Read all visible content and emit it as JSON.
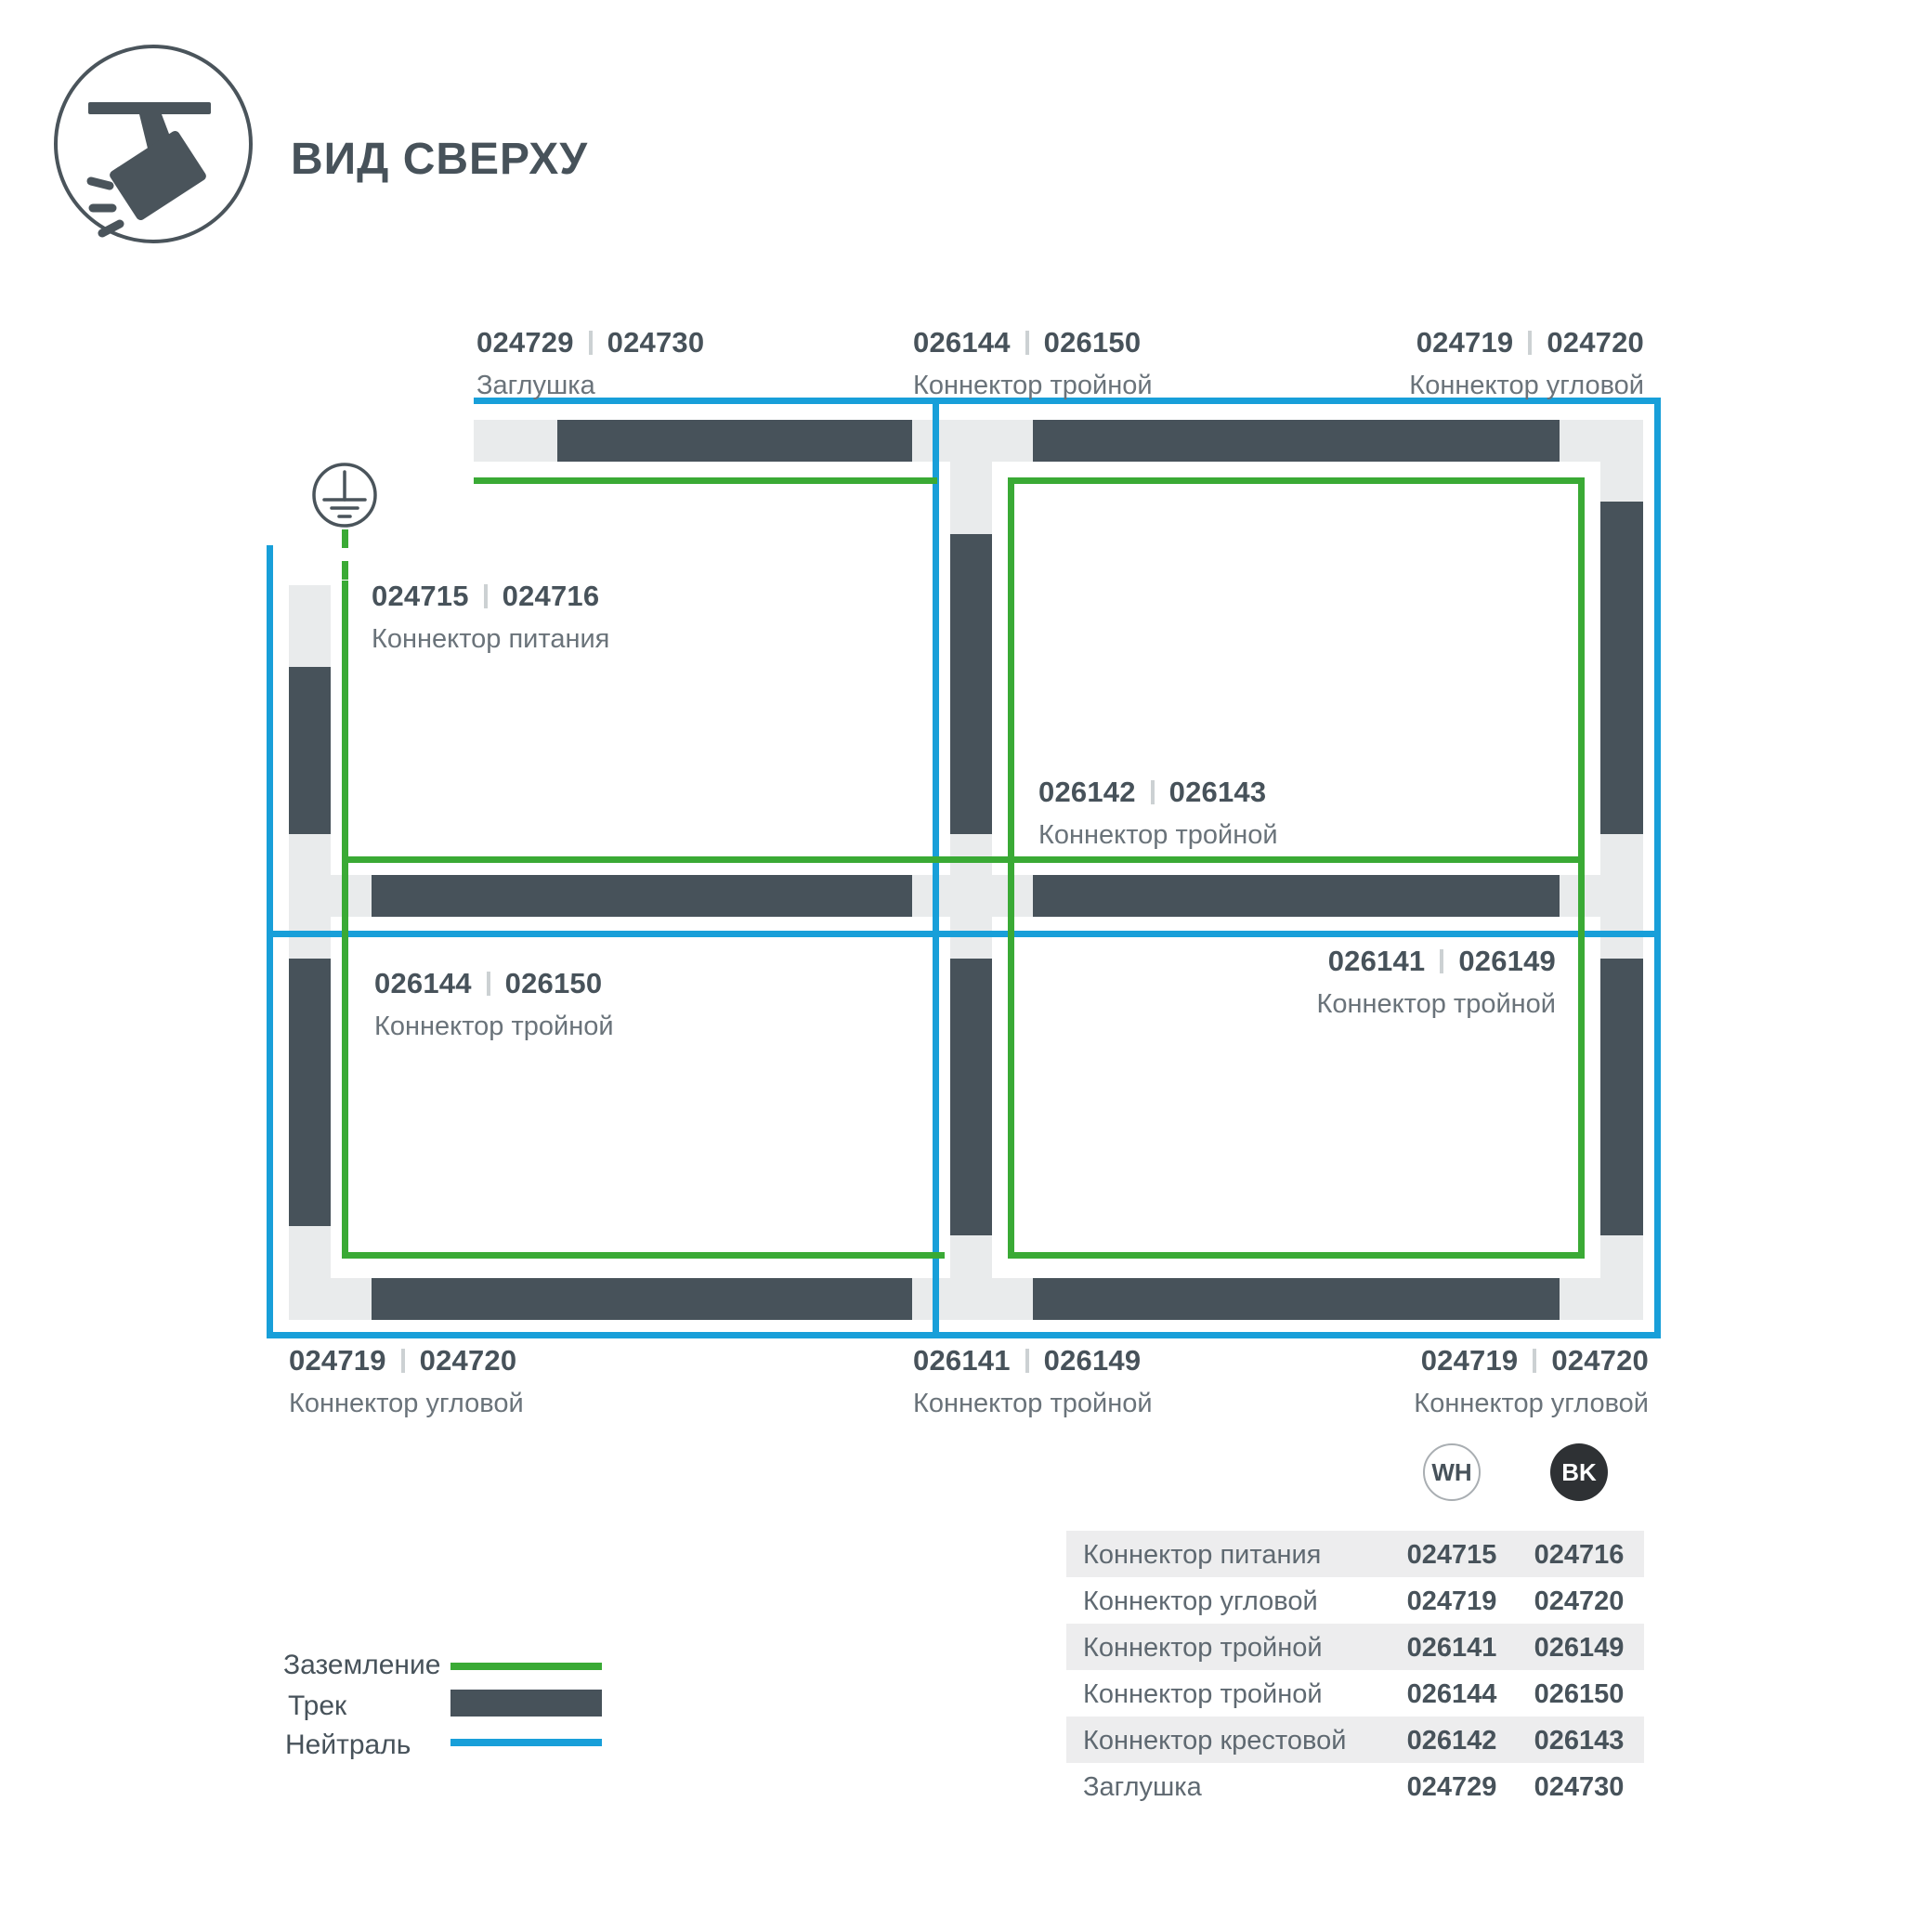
{
  "header": {
    "title": "ВИД СВЕРХУ"
  },
  "icons": {
    "spotlight": "spotlight-track-light",
    "ground": "earth-ground-symbol"
  },
  "colors": {
    "track": "#47525a",
    "connector": "#e9ebec",
    "ground": "#3aaa35",
    "neutral": "#189fd9",
    "chip_bk": "#2e3134",
    "row_shade": "#ededee"
  },
  "labels": {
    "top_left": {
      "wh": "024729",
      "bk": "024730",
      "name": "Заглушка"
    },
    "top_center": {
      "wh": "026144",
      "bk": "026150",
      "name": "Коннектор тройной"
    },
    "top_right": {
      "wh": "024719",
      "bk": "024720",
      "name": "Коннектор угловой"
    },
    "feed": {
      "wh": "024715",
      "bk": "024716",
      "name": "Коннектор питания"
    },
    "center": {
      "wh": "026142",
      "bk": "026143",
      "name": "Коннектор тройной"
    },
    "mid_left": {
      "wh": "026144",
      "bk": "026150",
      "name": "Коннектор тройной"
    },
    "mid_right": {
      "wh": "026141",
      "bk": "026149",
      "name": "Коннектор тройной"
    },
    "bottom_left": {
      "wh": "024719",
      "bk": "024720",
      "name": "Коннектор угловой"
    },
    "bottom_center": {
      "wh": "026141",
      "bk": "026149",
      "name": "Коннектор тройной"
    },
    "bottom_right": {
      "wh": "024719",
      "bk": "024720",
      "name": "Коннектор угловой"
    }
  },
  "legend": {
    "items": [
      {
        "label": "Заземление",
        "swatch": "ground-line"
      },
      {
        "label": "Трек",
        "swatch": "track-bar"
      },
      {
        "label": "Нейтраль",
        "swatch": "neutral-line"
      }
    ]
  },
  "table": {
    "col_wh": "WH",
    "col_bk": "BK",
    "rows": [
      {
        "name": "Коннектор питания",
        "wh": "024715",
        "bk": "024716"
      },
      {
        "name": "Коннектор угловой",
        "wh": "024719",
        "bk": "024720"
      },
      {
        "name": "Коннектор тройной",
        "wh": "026141",
        "bk": "026149"
      },
      {
        "name": "Коннектор тройной",
        "wh": "026144",
        "bk": "026150"
      },
      {
        "name": "Коннектор крестовой",
        "wh": "026142",
        "bk": "026143"
      },
      {
        "name": "Заглушка",
        "wh": "024729",
        "bk": "024730"
      }
    ]
  }
}
